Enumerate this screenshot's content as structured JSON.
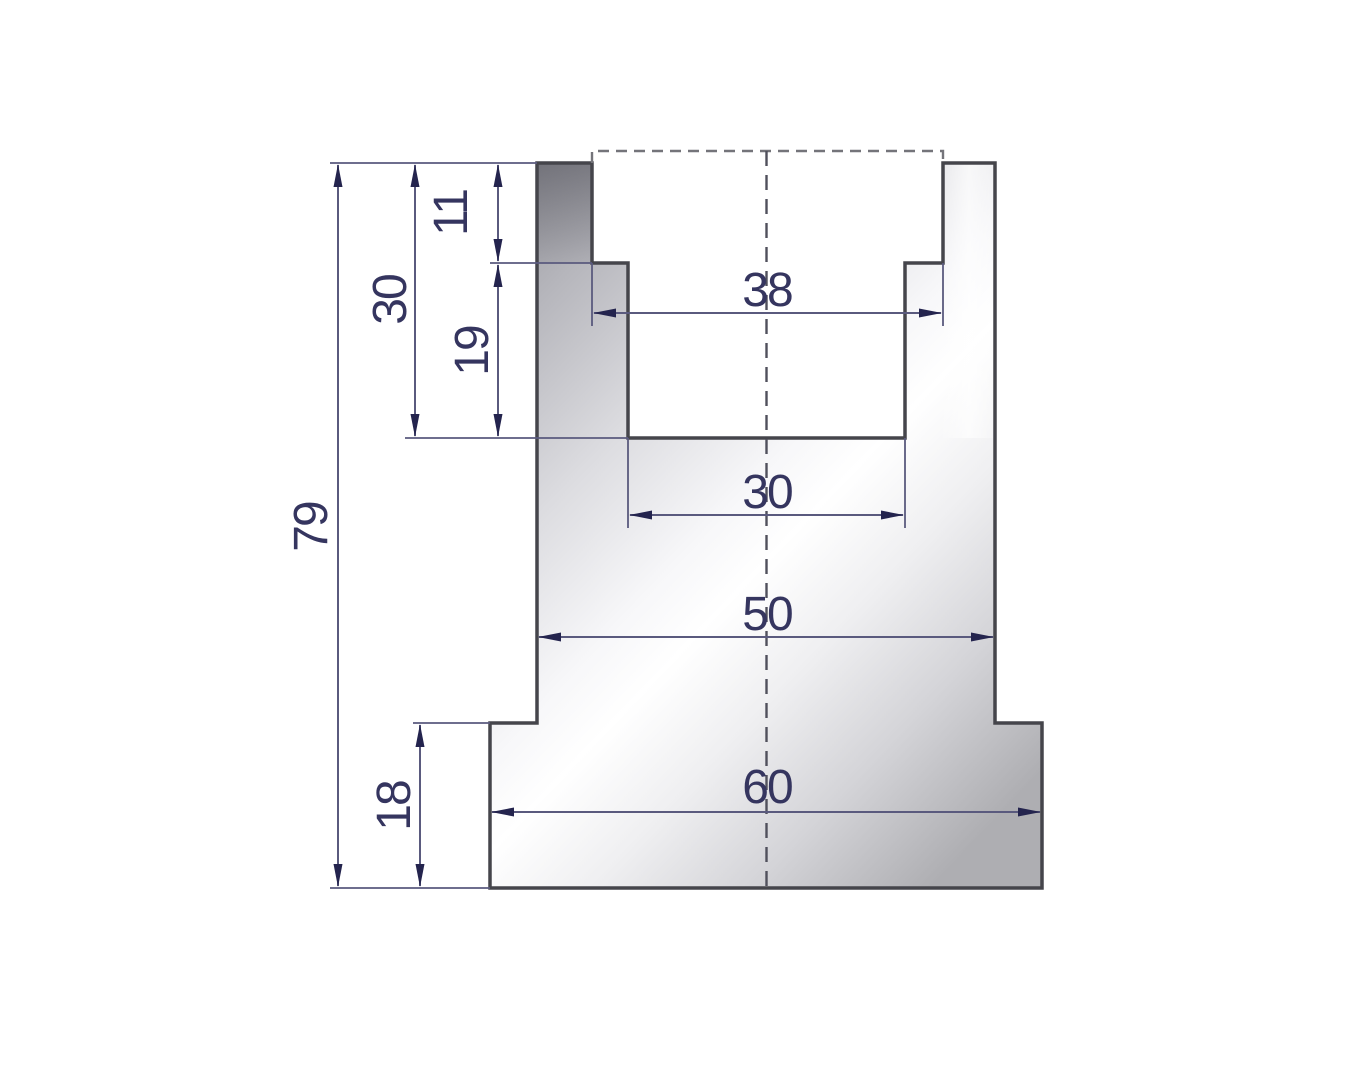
{
  "drawing": {
    "dimensions": {
      "height_total": "79",
      "height_groove": "30",
      "depth_upper_step": "11",
      "depth_lower_step": "19",
      "width_groove_top": "38",
      "width_groove_bottom": "30",
      "width_body": "50",
      "width_base": "60",
      "height_base": "18"
    },
    "colors": {
      "background": "#ffffff",
      "outline": "#45454b",
      "dimension_line": "#5a5a7e",
      "dimension_text": "#35355f",
      "arrowhead": "#24244e",
      "centerline": "#50505c",
      "hidden_dashed_line": "#74747a",
      "metal_dark": "#909096",
      "metal_light": "#ffffff"
    }
  }
}
